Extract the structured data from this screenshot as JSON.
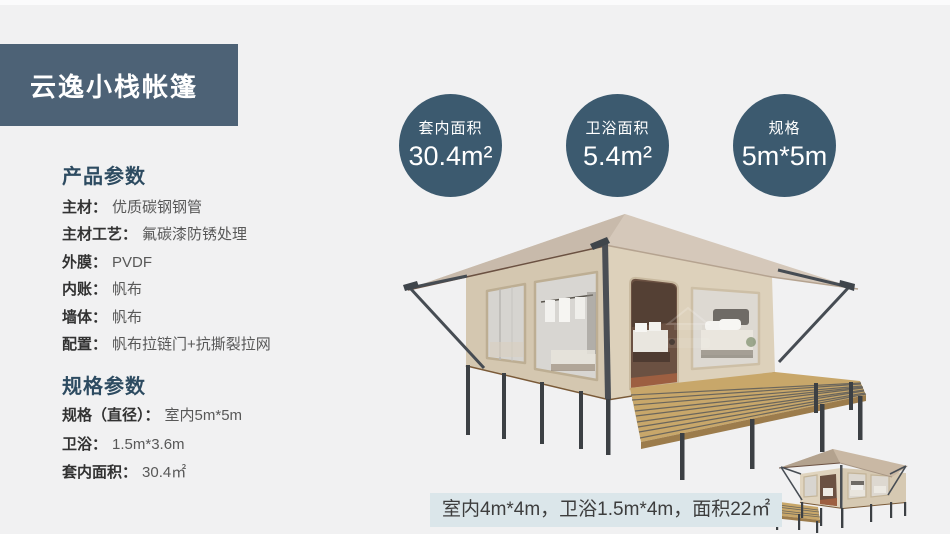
{
  "banner": {
    "title": "云逸小栈帐篷"
  },
  "product_params": {
    "heading": "产品参数",
    "items": [
      {
        "label": "主材：",
        "value": "优质碳钢钢管"
      },
      {
        "label": "主材工艺：",
        "value": "氟碳漆防锈处理"
      },
      {
        "label": "外膜：",
        "value": "PVDF"
      },
      {
        "label": "内账：",
        "value": "帆布"
      },
      {
        "label": "墙体：",
        "value": "帆布"
      },
      {
        "label": "配置：",
        "value": "帆布拉链门+抗撕裂拉网"
      }
    ]
  },
  "spec_params": {
    "heading": "规格参数",
    "items": [
      {
        "label": "规格（直径）：",
        "value": "室内5m*5m"
      },
      {
        "label": "卫浴：",
        "value": "1.5m*3.6m"
      },
      {
        "label": "套内面积：",
        "value": "30.4㎡"
      }
    ]
  },
  "badges": [
    {
      "title": "套内面积",
      "value": "30.4m²"
    },
    {
      "title": "卫浴面积",
      "value": "5.4m²"
    },
    {
      "title": "规格",
      "value": "5m*5m"
    }
  ],
  "footnote": {
    "text": "室内4m*4m，卫浴1.5m*4m，面积22㎡"
  },
  "icons": {
    "watermark": "house-emblem-watermark"
  },
  "colors": {
    "page_bg": "#f1f1f2",
    "banner_bg": "#4d6276",
    "badge_bg": "#3c5a6f",
    "heading": "#2d4b61",
    "label_text": "#323232",
    "value_text": "#585858",
    "footnote_bg": "#dbe6ea",
    "footnote_text": "#3d3d3d"
  }
}
